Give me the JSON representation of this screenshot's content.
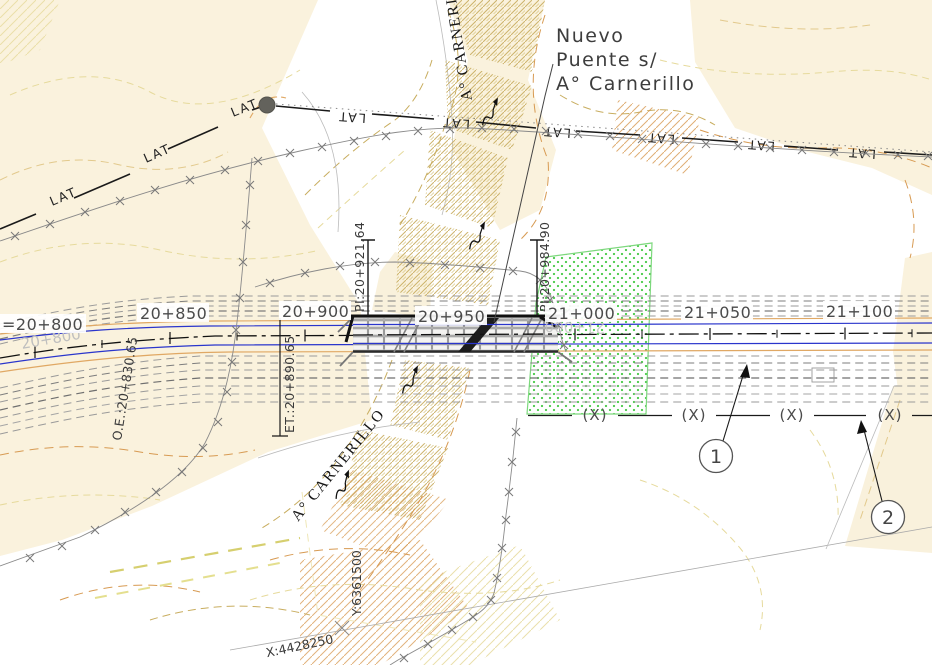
{
  "drawing": {
    "title": {
      "line1": "Nuevo",
      "line2": "Puente s/",
      "line3": "A° Carnerillo"
    },
    "stations": {
      "s800": "=20+800",
      "s850": "20+850",
      "s900": "20+900",
      "s950": "20+950",
      "s1000": "21+000",
      "s1050": "21+050",
      "s1100": "21+100"
    },
    "ghosts": {
      "g800": "20+800",
      "g1000": "21+000"
    },
    "pi_labels": {
      "pi1": "PI:20+921.64",
      "pi2": "PI:20+984.90"
    },
    "survey_labels": {
      "oe": "O.E.:20+830.65",
      "et": "ET.:20+890.65"
    },
    "labels": {
      "lat": "LAT",
      "xmark": "(X)",
      "stream": "A° CARNERILLO"
    },
    "callouts": {
      "c1": "1",
      "c2": "2"
    },
    "coordinates": {
      "x": "X:4428250",
      "y": "Y:6361500"
    },
    "colors": {
      "beige": "#faf2dd",
      "contour_tan": "#d79a52",
      "contour_olive": "#c8ad5f",
      "contour_pale": "#e6da9c",
      "road_blue": "#2a35cc",
      "road_orange": "#e0a864",
      "green_stipple": "#2ec22e",
      "bridge_gray": "#c9c9c9",
      "ink": "#1a1a1a"
    }
  }
}
